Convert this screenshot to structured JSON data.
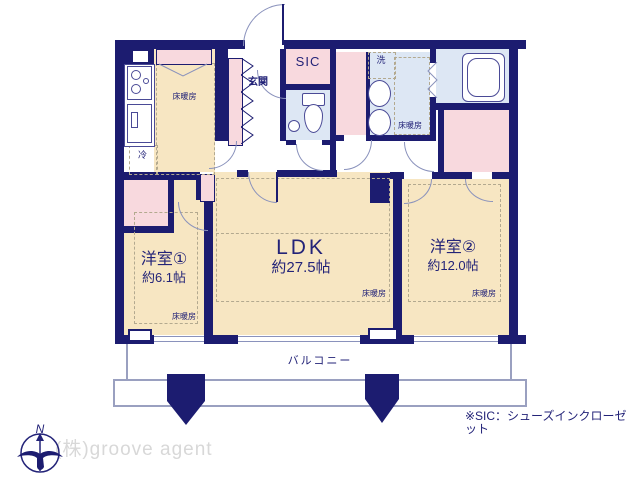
{
  "plan": {
    "kitchen": {
      "floor_heating": "床暖房",
      "fridge": "冷"
    },
    "entrance": {
      "label": "玄関"
    },
    "sic": {
      "label": "SIC"
    },
    "washroom": {
      "laundry": "洗",
      "floor_heating": "床暖房"
    },
    "ldk": {
      "name": "LDK",
      "area": "約27.5帖",
      "floor_heating": "床暖房"
    },
    "bedroom1": {
      "name": "洋室①",
      "area": "約6.1帖",
      "floor_heating": "床暖房"
    },
    "bedroom2": {
      "name": "洋室②",
      "area": "約12.0帖",
      "floor_heating": "床暖房"
    },
    "balcony": {
      "label": "バルコニー"
    }
  },
  "footer": {
    "note": "※SIC：シューズインクローゼット",
    "company": "(株)groove agent",
    "compass_north": "N"
  },
  "colors": {
    "wall_navy": "#1c1c70",
    "floor_beige": "#f7e6c2",
    "closet_pink": "#f8d9de",
    "wet_area_blue": "#dde7f4",
    "label_navy": "#232378",
    "watermark_gray": "#d8d8d8"
  }
}
